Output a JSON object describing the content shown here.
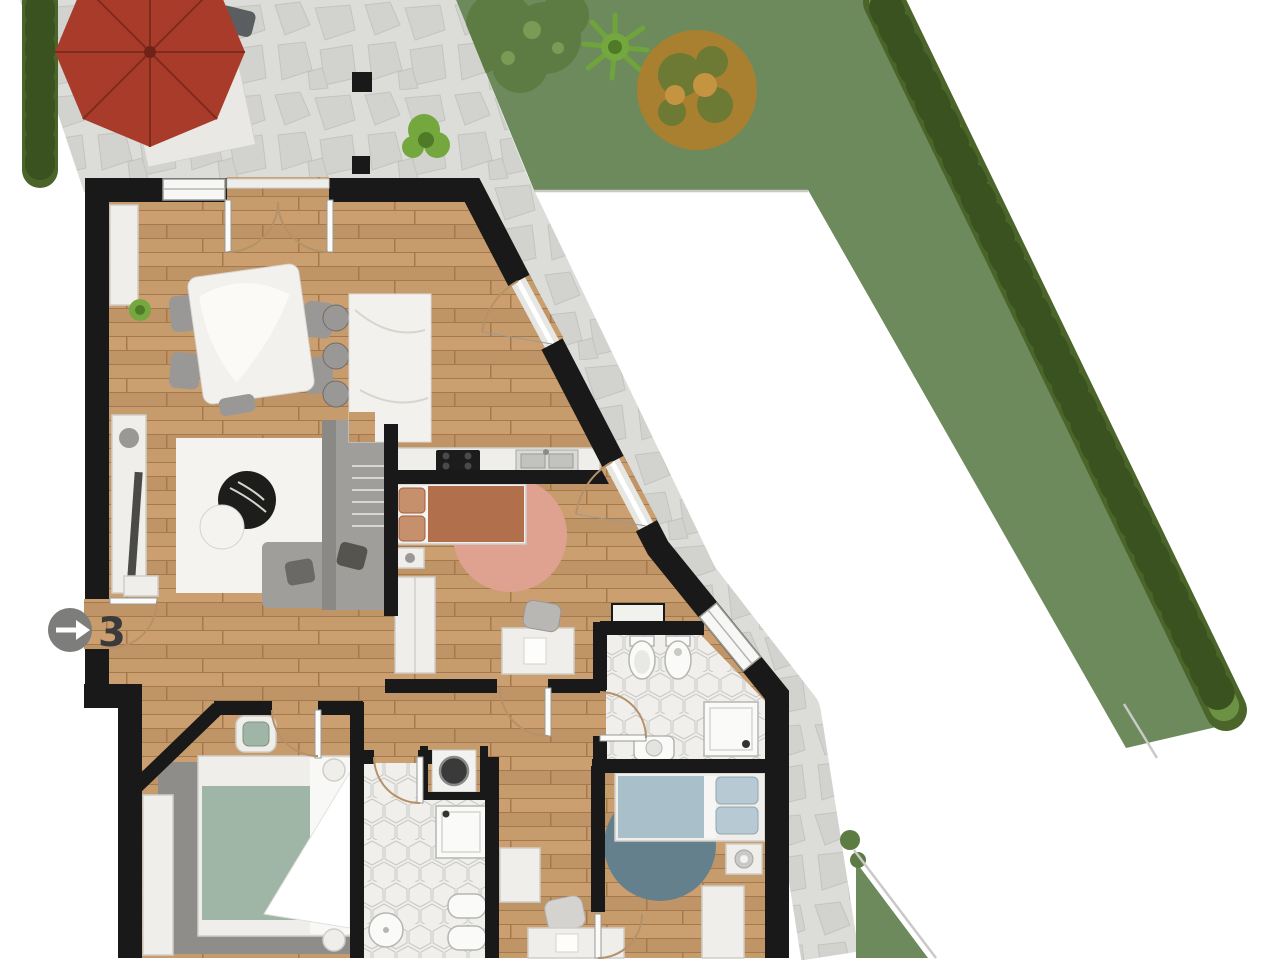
{
  "entrance": {
    "unit_label": "3",
    "badge_icon": "arrow-right-icon"
  },
  "colors": {
    "wall": "#191919",
    "wood": "#c59a6a",
    "stone": "#dcdcd8",
    "stone_line": "#c3c3bf",
    "lawn": "#6d8a5d",
    "hedge": "#4a6429",
    "hedge_light": "#6d9143",
    "hedge_dark": "#3a521f",
    "boundary": "#c9c9c6",
    "tile": "#f0efec",
    "tile_line": "#c9c8c4",
    "furniture_white": "#efeeea",
    "furniture_stroke": "#cfcec9",
    "gray_furniture": "#9a9896",
    "chair_dark": "#5a5e60",
    "sofa": "#a09e9b",
    "rug_white": "#f4f3ef",
    "rug_pink": "#dfa190",
    "rug_blue": "#65808d",
    "rug_gray": "#8f8d8a",
    "bed_terracotta": "#b26f4b",
    "pillow_terracotta": "#c5906b",
    "bed_green": "#9fb6a6",
    "bed_blue": "#a9bfca",
    "umbrella": "#a93b2a",
    "black_appliance": "#1c1c1c",
    "badge": "#7d7d7b",
    "label": "#3a3a3a",
    "arc": "#b5916a",
    "shrub_dark": "#5d7c44",
    "shrub_light": "#7a9b55",
    "tree_orange": "#a8802f",
    "tree_olive": "#6c7a34"
  },
  "scene": {
    "areas": [
      {
        "name": "terrace",
        "features": [
          "stone-paving",
          "parasol",
          "outdoor-dining-table",
          "outdoor-chairs",
          "hedge",
          "potted-plant",
          "column"
        ]
      },
      {
        "name": "garden-lawn",
        "features": [
          "grass",
          "bush",
          "agave-plant",
          "orange-tree",
          "perimeter-hedge"
        ]
      },
      {
        "name": "neighbor-area",
        "features": [
          "boundary-lines"
        ]
      },
      {
        "name": "side-walkway",
        "features": [
          "stone-paving",
          "shrubs",
          "grass-corner"
        ]
      }
    ],
    "rooms": [
      {
        "name": "living-dining-room",
        "furniture": [
          "dining-table",
          "dining-chairs",
          "sideboard",
          "media-console",
          "area-rug",
          "sectional-sofa",
          "coffee-table",
          "side-table",
          "ottoman",
          "plant",
          "french-door"
        ]
      },
      {
        "name": "kitchen",
        "furniture": [
          "island-counter",
          "bar-stools",
          "counter",
          "cooktop",
          "double-sink",
          "glass-door"
        ]
      },
      {
        "name": "bedroom-1",
        "furniture": [
          "double-bed",
          "nightstand",
          "round-rug",
          "wardrobe",
          "desk",
          "desk-chair",
          "glass-door"
        ]
      },
      {
        "name": "bathroom-1",
        "furniture": [
          "toilet",
          "bidet",
          "shower",
          "washbasin",
          "wall-shelf",
          "window"
        ]
      },
      {
        "name": "bedroom-2",
        "furniture": [
          "double-bed",
          "rug",
          "pouf",
          "wardrobe"
        ]
      },
      {
        "name": "bathroom-2",
        "furniture": [
          "shower",
          "washbasin",
          "toilet",
          "bidet",
          "washing-machine"
        ]
      },
      {
        "name": "bedroom-3",
        "furniture": [
          "double-bed",
          "nightstand",
          "table-lamp",
          "round-rug",
          "desk",
          "desk-chair",
          "cabinet"
        ]
      },
      {
        "name": "hallway",
        "furniture": [
          "entrance-door",
          "console",
          "cabinet"
        ]
      }
    ]
  }
}
